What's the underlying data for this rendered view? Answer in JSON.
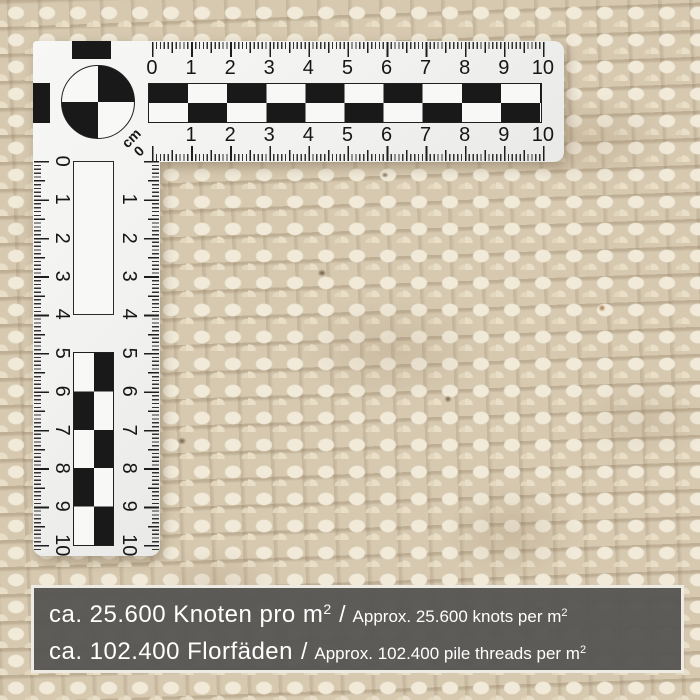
{
  "ruler": {
    "unit": "cm",
    "corner_zero": "0",
    "h_top": [
      "0",
      "1",
      "2",
      "3",
      "4",
      "5",
      "6",
      "7",
      "8",
      "9",
      "10"
    ],
    "h_bottom": [
      "1",
      "2",
      "3",
      "4",
      "5",
      "6",
      "7",
      "8",
      "9",
      "10"
    ],
    "v_left": [
      "0",
      "1",
      "2",
      "3",
      "4",
      "5",
      "6",
      "7",
      "8",
      "9",
      "10"
    ],
    "v_right": [
      "1",
      "2",
      "3",
      "4",
      "5",
      "6",
      "7",
      "8",
      "9",
      "10"
    ]
  },
  "info": {
    "line1": {
      "de": "ca. 25.600 Knoten pro m",
      "de_sup": "2",
      "sep": "/",
      "en": "Approx. 25.600 knots per m",
      "en_sup": "2"
    },
    "line2": {
      "de": "ca. 102.400 Florfäden",
      "sep": "/",
      "en": "Approx. 102.400 pile threads per m",
      "en_sup": "2"
    }
  },
  "colors": {
    "carpet_light": "#f1ead9",
    "carpet_mid": "#d6c9b0",
    "carpet_dark": "#927858",
    "ruler_body": "#f4f4f2",
    "ruler_ink": "#191919",
    "banner_bg": "#585754",
    "banner_border": "#eeebe4",
    "banner_text": "#ffffff"
  }
}
